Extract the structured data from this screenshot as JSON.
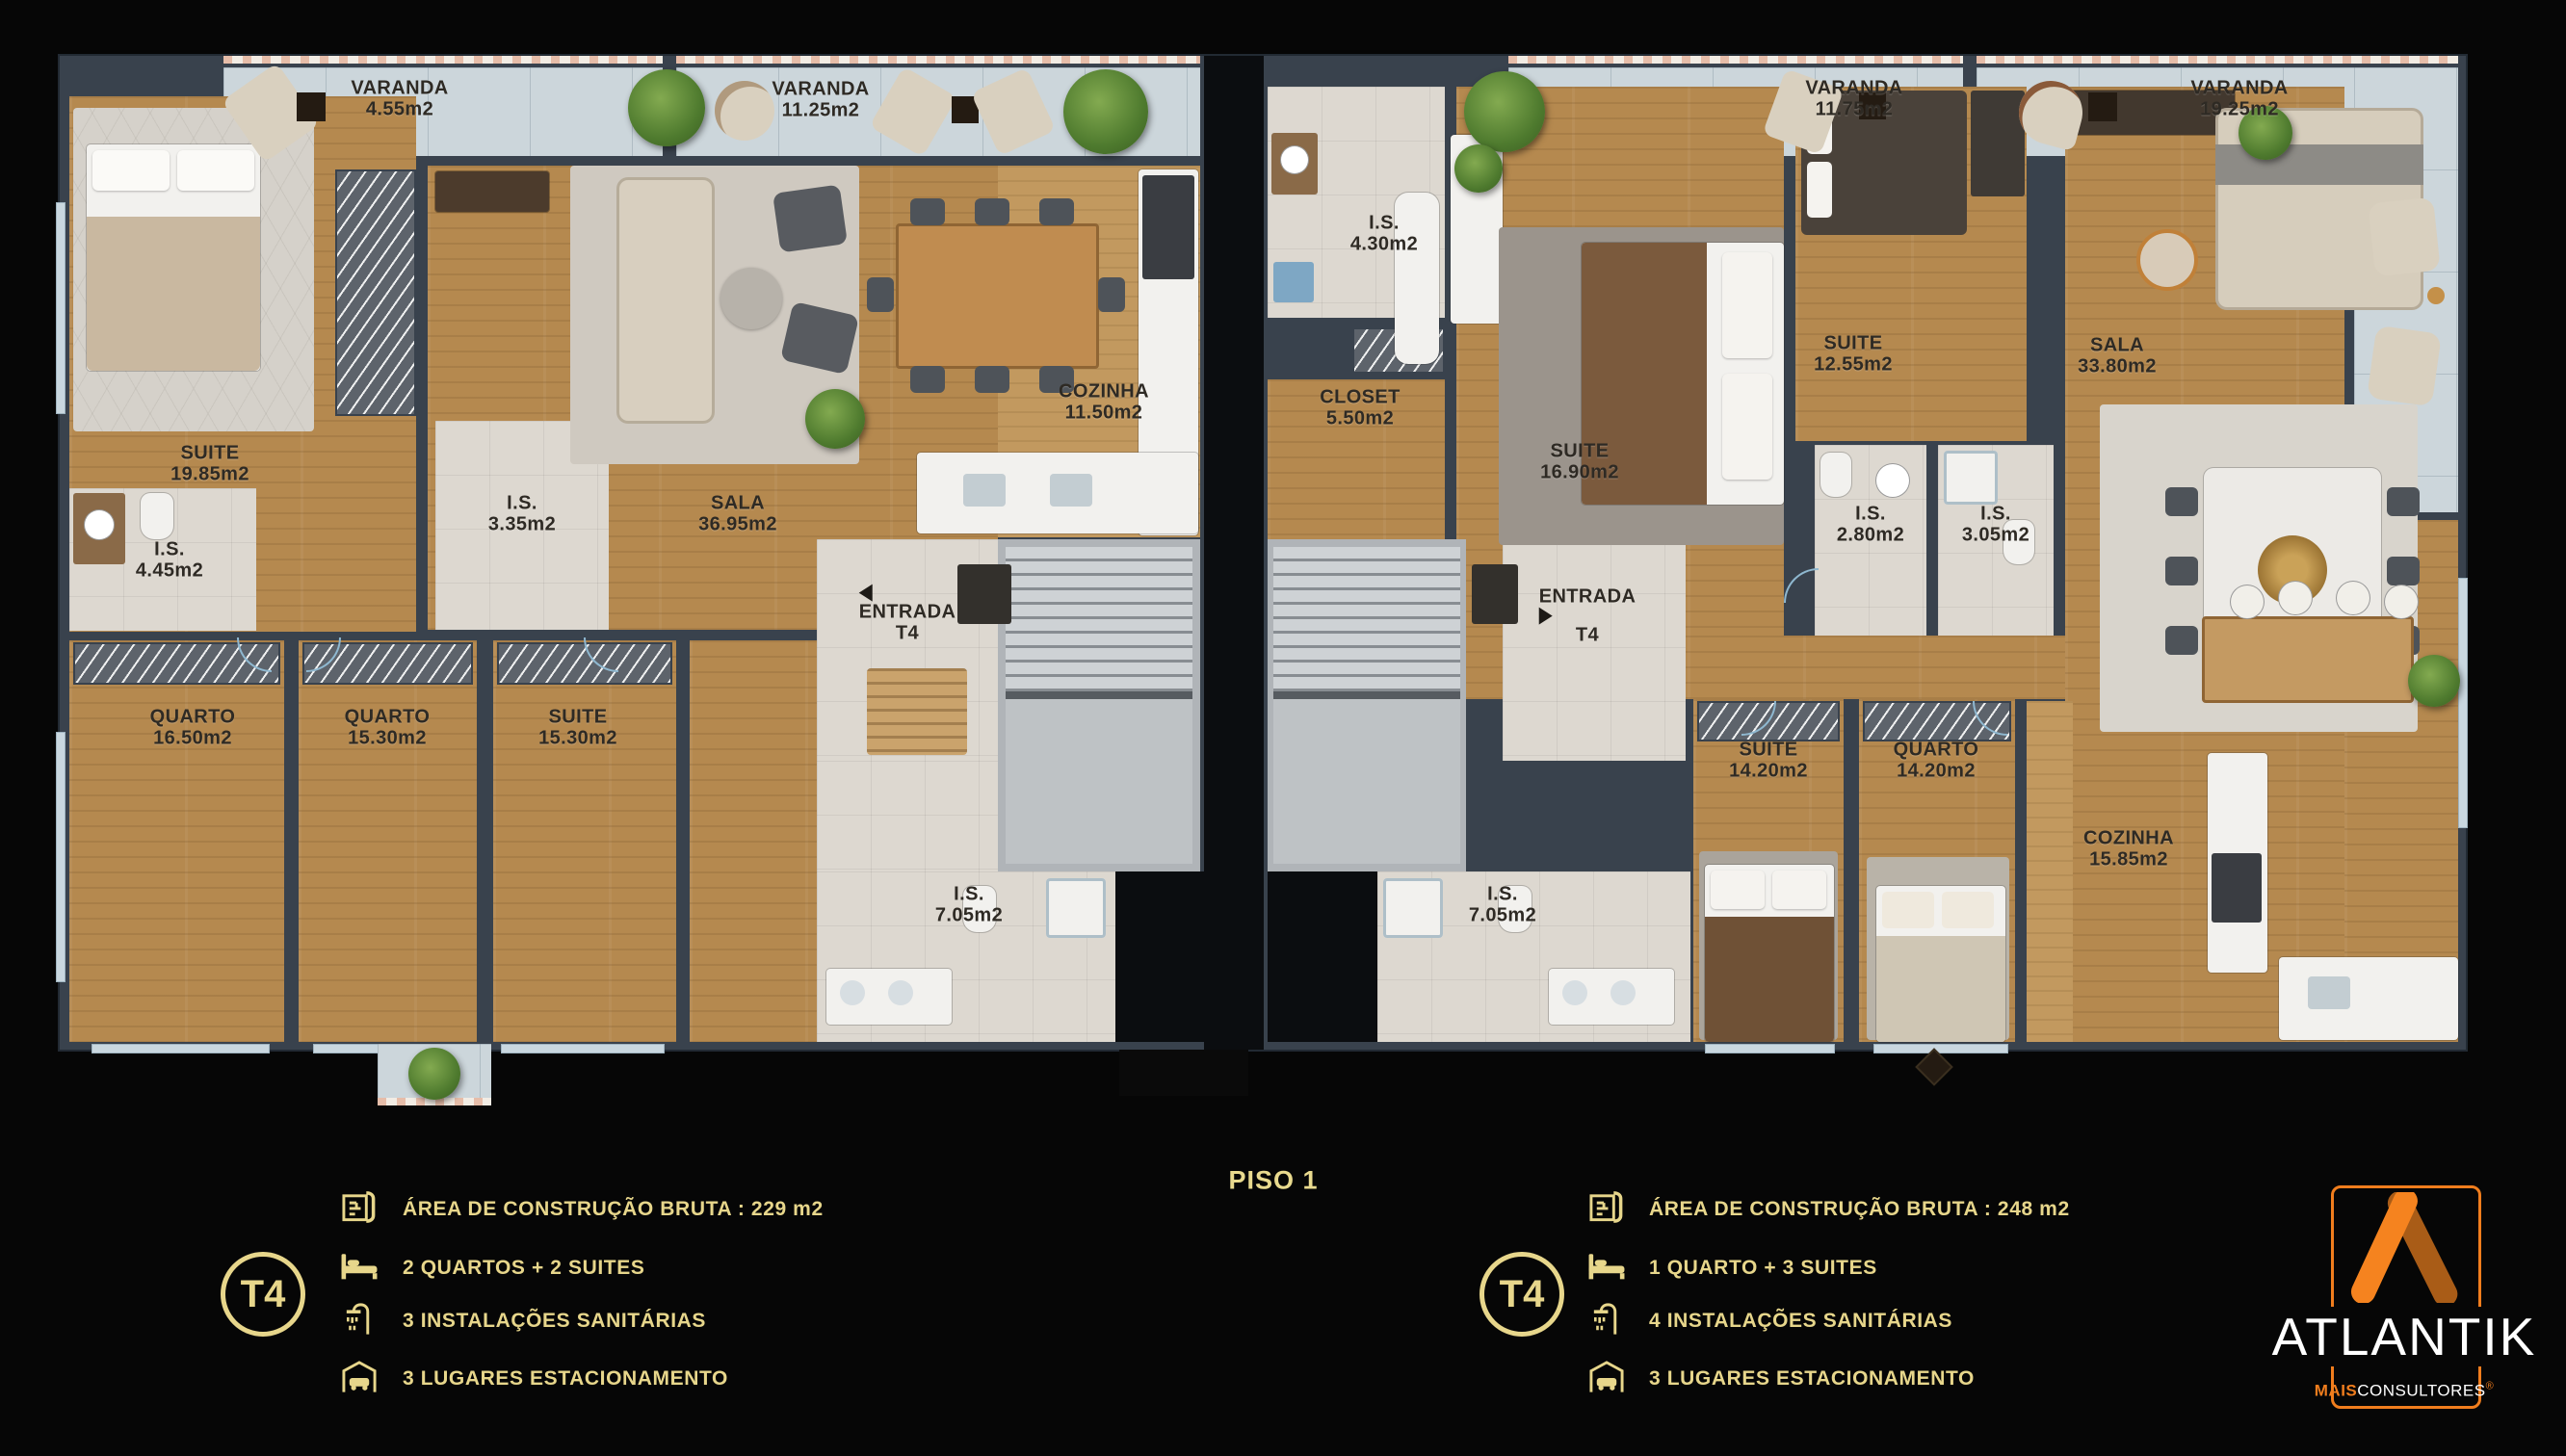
{
  "floor_title": "PISO 1",
  "varandas": [
    {
      "name": "VARANDA",
      "area": "4.55m2"
    },
    {
      "name": "VARANDA",
      "area": "11.25m2"
    },
    {
      "name": "VARANDA",
      "area": "11.75m2"
    },
    {
      "name": "VARANDA",
      "area": "19.25m2"
    }
  ],
  "left_unit": {
    "rooms": [
      {
        "name": "SUITE",
        "area": "19.85m2"
      },
      {
        "name": "I.S.",
        "area": "4.45m2"
      },
      {
        "name": "I.S.",
        "area": "3.35m2"
      },
      {
        "name": "SALA",
        "area": "36.95m2"
      },
      {
        "name": "COZINHA",
        "area": "11.50m2"
      },
      {
        "name": "ENTRADA",
        "area": "T4"
      },
      {
        "name": "QUARTO",
        "area": "16.50m2"
      },
      {
        "name": "QUARTO",
        "area": "15.30m2"
      },
      {
        "name": "SUITE",
        "area": "15.30m2"
      },
      {
        "name": "I.S.",
        "area": "7.05m2"
      }
    ]
  },
  "right_unit": {
    "rooms": [
      {
        "name": "I.S.",
        "area": "4.30m2"
      },
      {
        "name": "CLOSET",
        "area": "5.50m2"
      },
      {
        "name": "SUITE",
        "area": "16.90m2"
      },
      {
        "name": "SUITE",
        "area": "12.55m2"
      },
      {
        "name": "SALA",
        "area": "33.80m2"
      },
      {
        "name": "I.S.",
        "area": "2.80m2"
      },
      {
        "name": "I.S.",
        "area": "3.05m2"
      },
      {
        "name": "ENTRADA",
        "area": "T4"
      },
      {
        "name": "SUITE",
        "area": "14.20m2"
      },
      {
        "name": "QUARTO",
        "area": "14.20m2"
      },
      {
        "name": "COZINHA",
        "area": "15.85m2"
      },
      {
        "name": "I.S.",
        "area": "7.05m2"
      }
    ]
  },
  "legend_left": {
    "badge": "T4",
    "rows": [
      {
        "icon": "blueprint-icon",
        "text": "ÁREA DE CONSTRUÇÃO BRUTA :  229 m2"
      },
      {
        "icon": "bed-icon",
        "text": "2 QUARTOS + 2 SUITES"
      },
      {
        "icon": "shower-icon",
        "text": "3 INSTALAÇÕES SANITÁRIAS"
      },
      {
        "icon": "garage-icon",
        "text": "3 LUGARES ESTACIONAMENTO"
      }
    ]
  },
  "legend_right": {
    "badge": "T4",
    "rows": [
      {
        "icon": "blueprint-icon",
        "text": "ÁREA DE CONSTRUÇÃO BRUTA :  248 m2"
      },
      {
        "icon": "bed-icon",
        "text": "1 QUARTO + 3 SUITES"
      },
      {
        "icon": "shower-icon",
        "text": "4 INSTALAÇÕES SANITÁRIAS"
      },
      {
        "icon": "garage-icon",
        "text": "3 LUGARES ESTACIONAMENTO"
      }
    ]
  },
  "logo": {
    "brand": "ATLANTIK",
    "sub_accent": "MAIS",
    "sub_main": "CONSULTORES",
    "sub_mark": "®"
  },
  "colors": {
    "gold": "#e7d68b",
    "orange": "#f07d1d",
    "orange_dark": "#a95c17",
    "wall": "#39424d",
    "wood": "#b5894f",
    "varanda_tile": "#ccd6db"
  }
}
